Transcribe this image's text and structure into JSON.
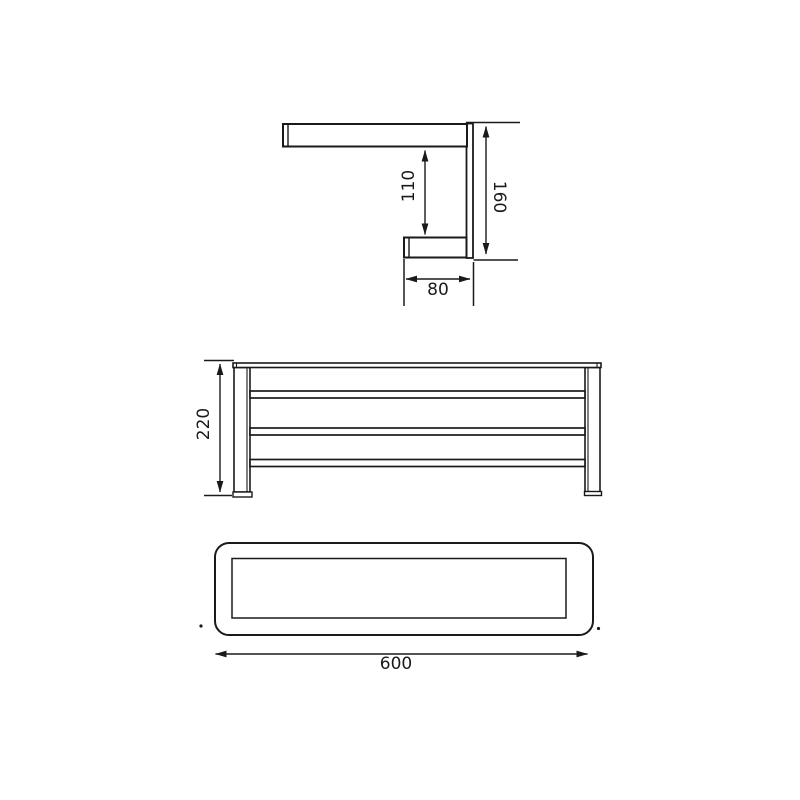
{
  "colors": {
    "line": "#1a1a1a",
    "background": "#ffffff"
  },
  "views": {
    "side": {
      "dim_inner_height": "110",
      "dim_total_height": "160",
      "dim_depth": "80"
    },
    "front": {
      "dim_height": "220"
    },
    "top": {
      "dim_width": "600"
    }
  }
}
